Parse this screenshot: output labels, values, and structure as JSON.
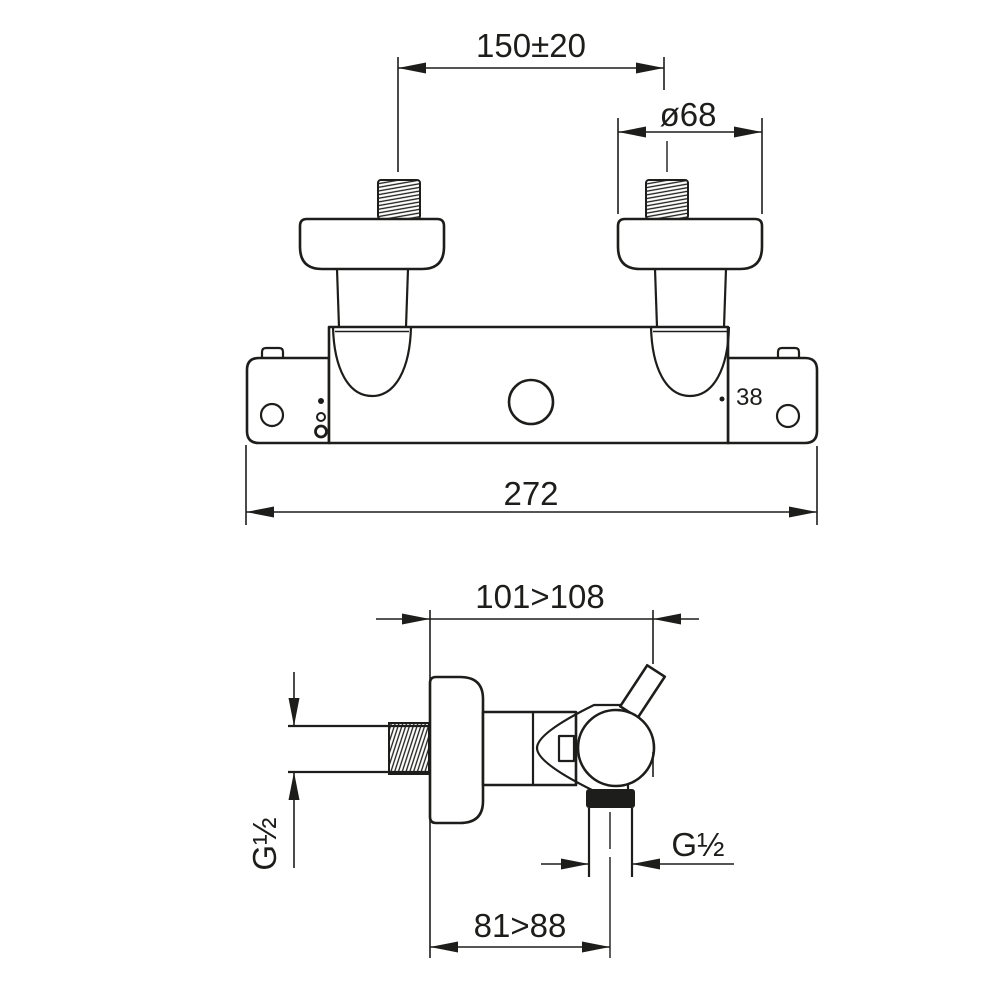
{
  "page": {
    "background": "#ffffff",
    "line_color": "#1d1d1b",
    "description": "Technical installation drawing of a wall-mounted thermostatic shower mixer, front view and side view with dimensions"
  },
  "front_view": {
    "name": "front-view",
    "dim_center_distance": "150±20",
    "dim_escutcheon_diameter": "ø68",
    "dim_total_width": "272",
    "label_temperature_stop": "38"
  },
  "side_view": {
    "name": "side-view",
    "dim_depth": "101>108",
    "label_inlet_thread": "G½",
    "label_outlet_thread": "G½",
    "dim_outlet_offset": "81>88"
  }
}
